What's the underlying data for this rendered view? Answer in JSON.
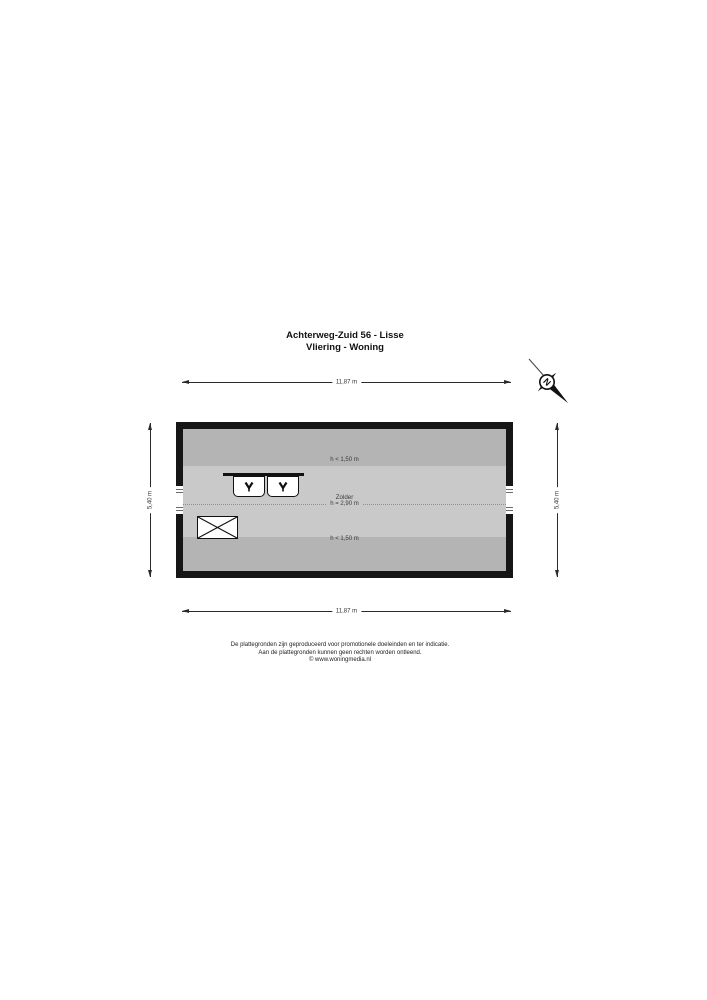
{
  "header": {
    "title_line1": "Achterweg-Zuid 56 - Lisse",
    "title_line2": "Vliering - Woning"
  },
  "compass": {
    "label": "N"
  },
  "dimensions": {
    "top": "11,87 m",
    "bottom": "11,87 m",
    "left": "5,40 m",
    "right": "5,40 m"
  },
  "floorplan": {
    "room_label": "Zolder",
    "room_height_label": "h = 2,90 m",
    "low_height_top_label": "h < 1,50 m",
    "low_height_bottom_label": "h < 1,50 m",
    "colors": {
      "wall": "#161616",
      "low_zone": "#b4b4b4",
      "main_zone": "#c9c9c9",
      "fixture_fill": "#ffffff"
    },
    "fixtures": {
      "roof_window_icon": "v-symbol",
      "hatch_icon": "crossed-rectangle",
      "window_icon": "double-pane-lines"
    }
  },
  "footer": {
    "disclaimer_line1": "De plattegronden zijn geproduceerd voor promotionele doeleinden en ter indicatie.",
    "disclaimer_line2": "Aan de plattegronden kunnen geen rechten worden ontleend.",
    "credit": "© www.woningmedia.nl"
  }
}
